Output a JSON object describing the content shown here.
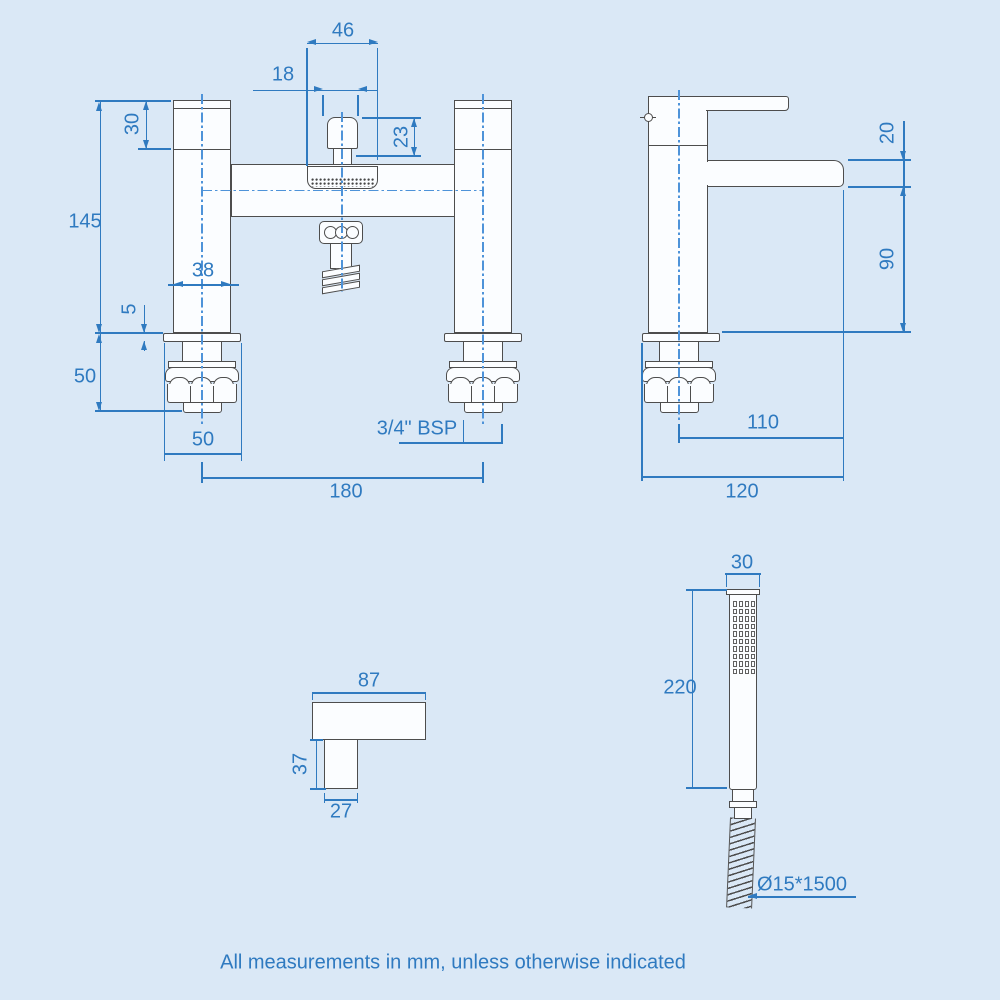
{
  "note": "All measurements in mm, unless otherwise indicated",
  "colors": {
    "background": "#dae8f6",
    "line": "#4d4d4d",
    "dimension": "#2f7ac0"
  },
  "front_view": {
    "dims": {
      "housing_width": "46",
      "knob_width": "18",
      "knob_height": "23",
      "head_height": "30",
      "overall_height": "145",
      "pillar_width": "38",
      "deck_thickness": "5",
      "shank_length": "50",
      "shank_width": "50",
      "thread": "3/4\" BSP",
      "centres": "180"
    }
  },
  "side_view": {
    "dims": {
      "spout_thickness": "20",
      "spout_height": "90",
      "spout_reach": "110",
      "overall_depth": "120"
    }
  },
  "handle_view": {
    "dims": {
      "length": "87",
      "drop": "37",
      "width": "27"
    }
  },
  "handset_view": {
    "dims": {
      "head_width": "30",
      "length": "220",
      "hose": "Ø15*1500"
    }
  }
}
